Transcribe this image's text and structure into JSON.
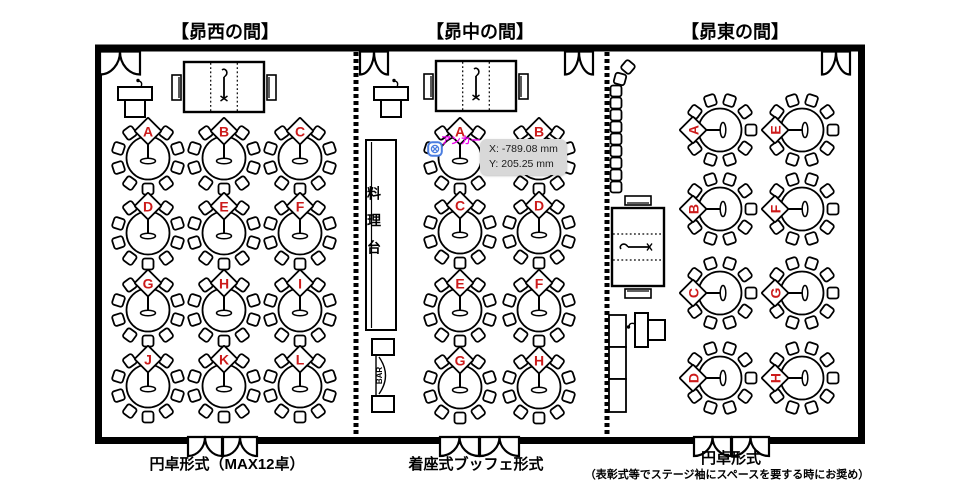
{
  "rooms": [
    {
      "id": "west",
      "title": "【昴西の間】",
      "caption": "円卓形式（MAX12卓）",
      "tables": [
        "A",
        "B",
        "C",
        "D",
        "E",
        "F",
        "G",
        "H",
        "I",
        "J",
        "K",
        "L"
      ]
    },
    {
      "id": "center",
      "title": "【昴中の間】",
      "caption": "着座式ブッフェ形式",
      "tables": [
        "A",
        "B",
        "C",
        "D",
        "E",
        "F",
        "G",
        "H"
      ]
    },
    {
      "id": "east",
      "title": "【昴東の間】",
      "caption": "円卓形式",
      "caption_note": "（表彰式等でステージ袖にスペースを要する時にお奨め）",
      "tables": [
        "A",
        "B",
        "C",
        "D",
        "E",
        "F",
        "G",
        "H"
      ]
    }
  ],
  "labels": {
    "food_station": "料理台",
    "bar": "BAR",
    "anchor": "アンカー"
  },
  "tooltip": {
    "x": "X: -789.08 mm",
    "y": "Y: 205.25 mm"
  },
  "colors": {
    "table_letter": "#cc1a1a",
    "anchor_label": "#ee00ee",
    "anchor_icon": "#4a7de0",
    "tooltip_bg": "#d8d8d8",
    "plan_line": "#000000"
  }
}
